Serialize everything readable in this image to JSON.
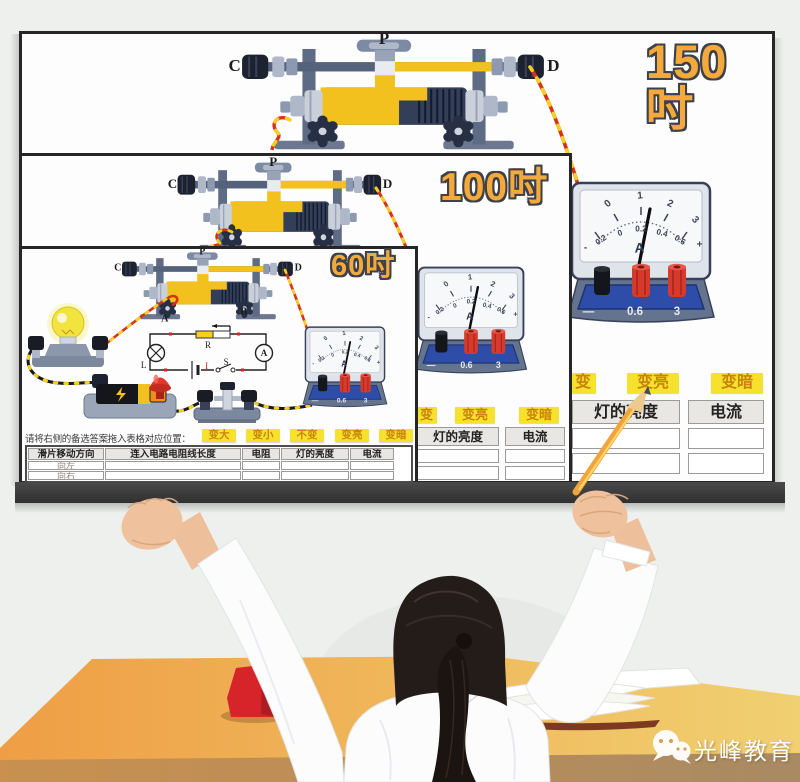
{
  "sizes": {
    "s150": "150吋",
    "s100": "100吋",
    "s60": "60吋"
  },
  "rheostat": {
    "slider": "P",
    "left_terminal": "C",
    "right_terminal": "D",
    "bottom_left": "A",
    "bottom_right": "B"
  },
  "ammeter": {
    "upper_scale": [
      "0",
      "1",
      "2",
      "3"
    ],
    "lower_scale": [
      "0.2",
      "0",
      "0.2",
      "0.4",
      "0.6"
    ],
    "sign_minus": "-",
    "sign_plus": "+",
    "unit": "A",
    "base_labels": [
      "—",
      "0.6",
      "3"
    ]
  },
  "schematic": {
    "rheostat": "R",
    "lamp": "L",
    "ammeter": "A",
    "switch": "S",
    "current": "I"
  },
  "quiz": {
    "instruction": "请将右侧的备选答案拖入表格对应位置：",
    "options": [
      "变大",
      "变小",
      "不变",
      "变亮",
      "变暗"
    ],
    "cropped_option": "变",
    "table": {
      "headers": [
        "滑片移动方向",
        "连入电路电阻线长度",
        "电阻",
        "灯的亮度",
        "电流"
      ],
      "rows": [
        "向左",
        "向右"
      ]
    }
  },
  "watermark": {
    "brand": "光峰教育"
  }
}
